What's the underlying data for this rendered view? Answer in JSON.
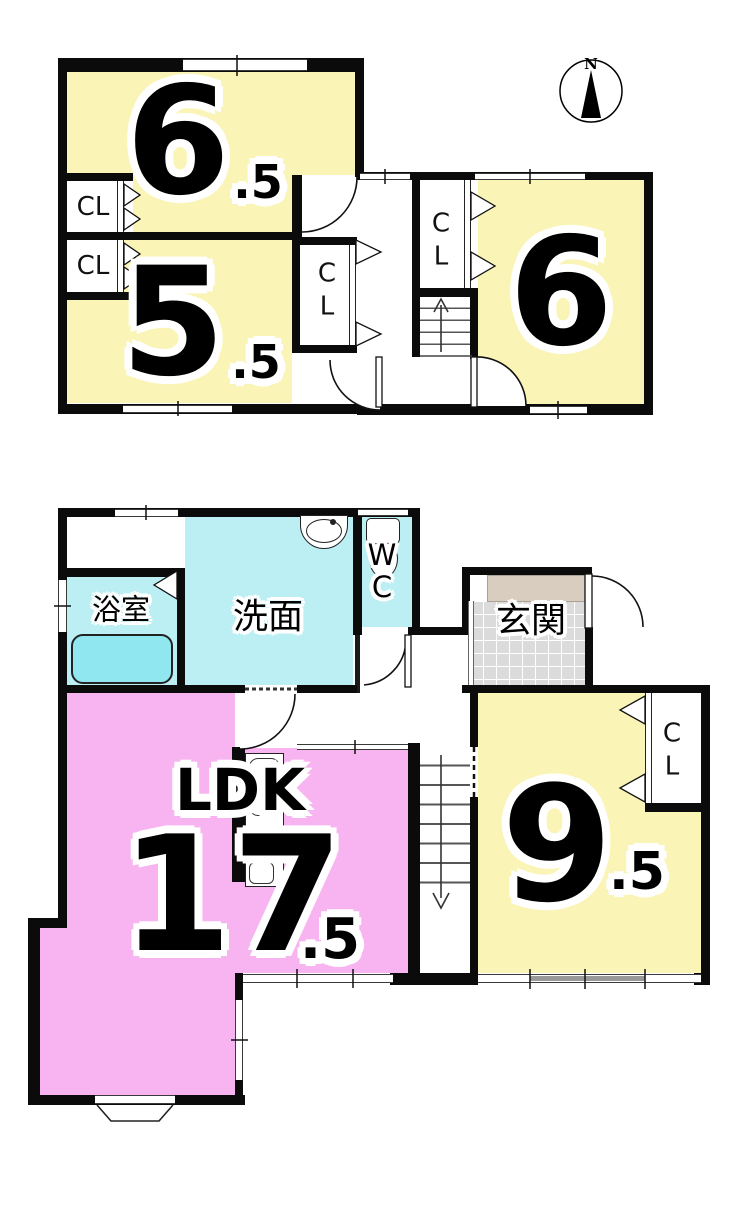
{
  "title": "2-story house floor plan",
  "compass": {
    "label": "N"
  },
  "floor2": {
    "room_6_5": {
      "value": "6",
      "suffix": ".5"
    },
    "room_5_5": {
      "value": "5",
      "suffix": ".5"
    },
    "room_6": {
      "value": "6"
    },
    "closet_label": "CL",
    "closet_vertical": [
      "C",
      "L"
    ],
    "stair_direction": "up"
  },
  "floor1": {
    "bath": "浴室",
    "washroom": "洗面",
    "wc_vertical": [
      "W",
      "C"
    ],
    "entrance": "玄関",
    "ldk": {
      "name": "LDK",
      "value": "17",
      "suffix": ".5"
    },
    "room_9_5": {
      "value": "9",
      "suffix": ".5"
    },
    "closet_vertical": [
      "C",
      "L"
    ],
    "stair_direction": "down"
  },
  "colors": {
    "room_yellow": "#faf4b6",
    "ldk_pink": "#f8b4f0",
    "water_cyan": "#bceff4",
    "tub_cyan": "#90e7ef",
    "tile_gray": "#dbdbdb",
    "entry_step_beige": "#d8cdbf",
    "wall_black": "#0b0b0b"
  }
}
